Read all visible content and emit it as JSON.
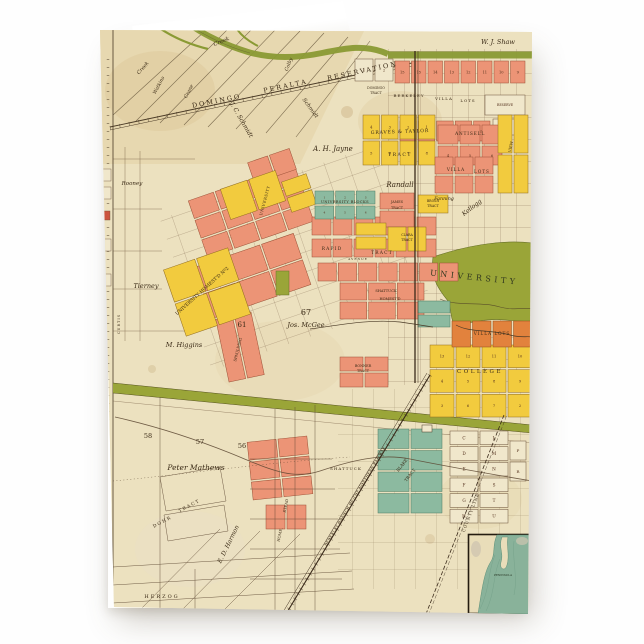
{
  "card": {
    "kind": "folded-greeting-card",
    "background_color": "#fefefe"
  },
  "map": {
    "colors": {
      "paper": "#ece1bf",
      "paper_dark": "#e3d1a4",
      "salmon": "#ec9476",
      "yellow": "#f2cb3e",
      "orange": "#e2823d",
      "teal": "#8cbaa0",
      "olive": "#9aa538",
      "creek": "#8a9a34",
      "water": "#89b29a",
      "cream": "#f0e7cb",
      "line": "#4a3a26",
      "text": "#3a2a16"
    },
    "clusters": [
      {
        "n": "top-numbers-row",
        "f": "salmon",
        "x": 295,
        "y": 32,
        "w": 130,
        "h": 22,
        "r": 1,
        "c": 8,
        "cl": [
          "15",
          "15",
          "14",
          "13",
          "12",
          "11",
          "10",
          "9"
        ]
      },
      {
        "n": "villa-17-21-row",
        "f": "salmon",
        "x": 300,
        "y": 92,
        "w": 90,
        "h": 20,
        "r": 1,
        "c": 5,
        "cl": [
          "17",
          "18",
          "19",
          "20",
          "21"
        ]
      },
      {
        "n": "reserve-block",
        "f": "cream",
        "x": 385,
        "y": 66,
        "w": 40,
        "h": 20,
        "r": 1,
        "c": 1,
        "cl": [
          "RESERVE"
        ],
        "ls": 3.2
      },
      {
        "n": "block-24",
        "f": "cream",
        "x": 393,
        "y": 90,
        "w": 22,
        "h": 16,
        "r": 1,
        "c": 1,
        "cl": [
          "24"
        ],
        "ls": 3.6
      },
      {
        "n": "blocks-1-2",
        "f": "cream",
        "x": 255,
        "y": 30,
        "w": 38,
        "h": 22,
        "r": 1,
        "c": 2,
        "cl": [
          "1",
          "2"
        ],
        "ls": 3.6
      },
      {
        "n": "graves-taylor",
        "f": "yellow",
        "x": 263,
        "y": 86,
        "w": 72,
        "h": 50,
        "r": 2,
        "c": 4,
        "cl": [
          "4",
          "3",
          "2",
          "1",
          "5",
          "6",
          "7",
          "8"
        ]
      },
      {
        "n": "antisell",
        "f": "salmon",
        "x": 338,
        "y": 96,
        "w": 64,
        "h": 40,
        "r": 2,
        "c": 3,
        "cl": [
          "",
          "",
          "",
          "4",
          "5",
          "6"
        ]
      },
      {
        "n": "villa-lots-rows",
        "f": "salmon",
        "x": 335,
        "y": 128,
        "w": 58,
        "h": 36,
        "r": 2,
        "c": 3
      },
      {
        "n": "view-strip",
        "f": "yellow",
        "x": 398,
        "y": 86,
        "w": 30,
        "h": 78,
        "r": 2,
        "c": 2
      },
      {
        "n": "central-a",
        "f": "salmon",
        "x": 95,
        "y": 152,
        "w": 112,
        "h": 60,
        "r": 3,
        "c": 4,
        "a": -19
      },
      {
        "n": "central-b",
        "f": "salmon",
        "x": 100,
        "y": 220,
        "w": 105,
        "h": 54,
        "r": 2,
        "c": 3,
        "a": -19
      },
      {
        "n": "spaulding-strips",
        "f": "salmon",
        "x": 122,
        "y": 286,
        "w": 36,
        "h": 64,
        "r": 1,
        "c": 2,
        "a": -12
      },
      {
        "n": "central-pair",
        "f": "salmon",
        "x": 150,
        "y": 126,
        "w": 44,
        "h": 22,
        "r": 1,
        "c": 2,
        "a": -19
      },
      {
        "n": "rapid-row-1",
        "f": "salmon",
        "x": 212,
        "y": 188,
        "w": 124,
        "h": 18,
        "r": 1,
        "c": 6
      },
      {
        "n": "rapid-row-2",
        "f": "salmon",
        "x": 212,
        "y": 210,
        "w": 124,
        "h": 18,
        "r": 1,
        "c": 6
      },
      {
        "n": "rapid-row-3",
        "f": "salmon",
        "x": 218,
        "y": 234,
        "w": 140,
        "h": 18,
        "r": 1,
        "c": 7
      },
      {
        "n": "shattuck-homestead",
        "f": "salmon",
        "x": 240,
        "y": 254,
        "w": 84,
        "h": 36,
        "r": 2,
        "c": 3
      },
      {
        "n": "james-tract",
        "f": "salmon",
        "x": 280,
        "y": 164,
        "w": 34,
        "h": 34,
        "r": 2,
        "c": 1
      },
      {
        "n": "brosh-tract",
        "f": "yellow",
        "x": 318,
        "y": 166,
        "w": 30,
        "h": 18,
        "r": 1,
        "c": 1
      },
      {
        "n": "bonner-tract",
        "f": "salmon",
        "x": 240,
        "y": 328,
        "w": 48,
        "h": 30,
        "r": 2,
        "c": 2
      },
      {
        "n": "mathews-blocks",
        "f": "salmon",
        "x": 150,
        "y": 410,
        "w": 60,
        "h": 58,
        "r": 3,
        "c": 2,
        "a": -6
      },
      {
        "n": "mathews-pair",
        "f": "salmon",
        "x": 166,
        "y": 476,
        "w": 40,
        "h": 24,
        "r": 1,
        "c": 2
      },
      {
        "n": "place-yellow",
        "f": "yellow",
        "x": 124,
        "y": 150,
        "w": 58,
        "h": 32,
        "r": 1,
        "c": 2,
        "a": -19
      },
      {
        "n": "place-yellow-small",
        "f": "yellow",
        "x": 186,
        "y": 148,
        "w": 26,
        "h": 32,
        "r": 2,
        "c": 1,
        "a": -19
      },
      {
        "n": "university-homestead-2",
        "f": "yellow",
        "x": 73,
        "y": 228,
        "w": 68,
        "h": 70,
        "r": 2,
        "c": 2,
        "a": -19
      },
      {
        "n": "clara-pair",
        "f": "yellow",
        "x": 256,
        "y": 194,
        "w": 30,
        "h": 26,
        "r": 2,
        "c": 1
      },
      {
        "n": "clara-tract",
        "f": "yellow",
        "x": 288,
        "y": 198,
        "w": 38,
        "h": 24,
        "r": 1,
        "c": 2
      },
      {
        "n": "college-homestead",
        "f": "yellow",
        "x": 330,
        "y": 316,
        "w": 102,
        "h": 72,
        "r": 3,
        "c": 4,
        "cl": [
          "13",
          "12",
          "11",
          "10",
          "4",
          "5",
          "8",
          "9",
          "3",
          "6",
          "7",
          "2"
        ]
      },
      {
        "n": "villa-lots-orange",
        "f": "orange",
        "x": 352,
        "y": 292,
        "w": 80,
        "h": 26,
        "r": 1,
        "c": 4
      },
      {
        "n": "university-blocks",
        "f": "teal",
        "x": 215,
        "y": 162,
        "w": 60,
        "h": 28,
        "r": 2,
        "c": 3,
        "cl": [
          "1",
          "2",
          "3",
          "4",
          "5",
          "6"
        ],
        "ls": 2.8
      },
      {
        "n": "blake-tract-1",
        "f": "teal",
        "x": 318,
        "y": 272,
        "w": 32,
        "h": 26,
        "r": 2,
        "c": 1
      },
      {
        "n": "blake-tract-grid",
        "f": "teal",
        "x": 278,
        "y": 400,
        "w": 64,
        "h": 84,
        "r": 4,
        "c": 2
      },
      {
        "n": "letter-blocks",
        "f": "cream",
        "x": 350,
        "y": 402,
        "w": 58,
        "h": 92,
        "r": 6,
        "c": 2,
        "cl": [
          "C",
          "L",
          "D",
          "M",
          "E",
          "N",
          "F",
          "S",
          "G",
          "T",
          "H",
          "U"
        ],
        "ls": 4.2
      },
      {
        "n": "letter-blocks-pr",
        "f": "cream",
        "x": 410,
        "y": 412,
        "w": 16,
        "h": 40,
        "r": 2,
        "c": 1,
        "cl": [
          "P",
          "R"
        ],
        "ls": 4
      },
      {
        "n": "olive-block",
        "f": "olive",
        "x": 176,
        "y": 242,
        "w": 13,
        "h": 24,
        "r": 1,
        "c": 1
      }
    ],
    "labels": [
      {
        "t": "W. J. Shaw",
        "x": 398,
        "y": 15,
        "s": 6.5,
        "c": "it"
      },
      {
        "t": "DOMINGO",
        "x": 117,
        "y": 74,
        "r": -11,
        "s": 6.5,
        "sp": 2
      },
      {
        "t": "PERALTA",
        "x": 186,
        "y": 59,
        "r": -12,
        "s": 6.5,
        "sp": 2
      },
      {
        "t": "RESERVATION",
        "x": 263,
        "y": 44,
        "r": -12,
        "s": 6.5,
        "sp": 2
      },
      {
        "t": "Creek",
        "x": 122,
        "y": 14,
        "r": -22,
        "s": 5.5,
        "c": "it"
      },
      {
        "t": "Creek",
        "x": 44,
        "y": 40,
        "r": -48,
        "s": 5,
        "c": "it"
      },
      {
        "t": "Watkins",
        "x": 60,
        "y": 57,
        "r": -62,
        "s": 4.8,
        "c": "it"
      },
      {
        "t": "Crane",
        "x": 90,
        "y": 63,
        "r": -62,
        "s": 4.8,
        "c": "it"
      },
      {
        "t": "Colby",
        "x": 190,
        "y": 36,
        "r": -68,
        "s": 4.8,
        "c": "it"
      },
      {
        "t": "J. C. Schmidt",
        "x": 140,
        "y": 92,
        "r": 60,
        "s": 6,
        "c": "it"
      },
      {
        "t": "Schmidt",
        "x": 209,
        "y": 80,
        "r": 54,
        "s": 5.5,
        "c": "it"
      },
      {
        "t": "A. H. Jayne",
        "x": 233,
        "y": 122,
        "s": 7,
        "c": "it"
      },
      {
        "t": "DOMINGO",
        "x": 276,
        "y": 60,
        "s": 3.2
      },
      {
        "t": "TRACT",
        "x": 276,
        "y": 65,
        "s": 3.2
      },
      {
        "t": "BERKELEY",
        "x": 309,
        "y": 68,
        "s": 4,
        "sp": 1
      },
      {
        "t": "VILLA",
        "x": 344,
        "y": 71,
        "s": 4,
        "sp": 1
      },
      {
        "t": "LOTS",
        "x": 368,
        "y": 73,
        "s": 4,
        "sp": 1
      },
      {
        "t": "GRAVES & TAYLOR",
        "x": 300,
        "y": 104,
        "r": -2,
        "s": 4.6,
        "sp": 0.8
      },
      {
        "t": "TRACT",
        "x": 300,
        "y": 127,
        "s": 4.6,
        "sp": 1.5
      },
      {
        "t": "ANTISELL",
        "x": 370,
        "y": 106,
        "s": 4.4,
        "sp": 0.8
      },
      {
        "t": "VILLA",
        "x": 356,
        "y": 142,
        "s": 4.2,
        "sp": 1
      },
      {
        "t": "LOTS",
        "x": 382,
        "y": 144,
        "s": 4.2,
        "sp": 1
      },
      {
        "t": "VIEW",
        "x": 412,
        "y": 118,
        "r": -78,
        "s": 3.8
      },
      {
        "t": "Randall",
        "x": 300,
        "y": 158,
        "s": 7,
        "c": "it"
      },
      {
        "t": "Fanning",
        "x": 344,
        "y": 171,
        "s": 4.8,
        "c": "it"
      },
      {
        "t": "Kellogg",
        "x": 373,
        "y": 180,
        "r": -38,
        "s": 6,
        "c": "it"
      },
      {
        "t": "JAMES",
        "x": 297,
        "y": 174,
        "s": 3.4
      },
      {
        "t": "TRACT",
        "x": 297,
        "y": 180,
        "s": 3.4
      },
      {
        "t": "BROSH",
        "x": 333,
        "y": 173,
        "s": 3.2
      },
      {
        "t": "TRACT",
        "x": 333,
        "y": 178,
        "s": 3.2
      },
      {
        "t": "UNIVERSITY BLOCKS",
        "x": 245,
        "y": 174,
        "s": 3.6,
        "sp": 0.4
      },
      {
        "t": "UNIVERSITY",
        "x": 166,
        "y": 172,
        "r": -75,
        "s": 3.8,
        "sp": 0.5
      },
      {
        "t": "RAPID",
        "x": 232,
        "y": 221,
        "s": 4.4,
        "sp": 1.2
      },
      {
        "t": "TRACT",
        "x": 282,
        "y": 225,
        "s": 4.4,
        "sp": 1.2
      },
      {
        "t": "AVENUE",
        "x": 258,
        "y": 231,
        "s": 3,
        "sp": 1
      },
      {
        "t": "SHATTUCK",
        "x": 286,
        "y": 263,
        "s": 3.6
      },
      {
        "t": "HOMEST'D",
        "x": 290,
        "y": 271,
        "s": 3.6
      },
      {
        "t": "UNIVERSITY",
        "x": 374,
        "y": 251,
        "r": 6,
        "s": 8,
        "sp": 3.5,
        "col": "#31381f"
      },
      {
        "t": "UNIVERSITY HOMEST'D Nº2",
        "x": 103,
        "y": 263,
        "r": -42,
        "s": 4.6
      },
      {
        "t": "SPAULDING",
        "x": 139,
        "y": 321,
        "r": -76,
        "s": 3.8
      },
      {
        "t": "Tierney",
        "x": 46,
        "y": 259,
        "s": 6.5,
        "c": "it"
      },
      {
        "t": "Rooney",
        "x": 32,
        "y": 156,
        "s": 5.5,
        "c": "it"
      },
      {
        "t": "61",
        "x": 142,
        "y": 298,
        "s": 7
      },
      {
        "t": "67",
        "x": 206,
        "y": 286,
        "s": 8
      },
      {
        "t": "Jos. McGee",
        "x": 206,
        "y": 298,
        "s": 6.5,
        "c": "it"
      },
      {
        "t": "M. Higgins",
        "x": 84,
        "y": 318,
        "s": 6.5,
        "c": "it"
      },
      {
        "t": "58",
        "x": 48,
        "y": 409,
        "s": 6.5
      },
      {
        "t": "57",
        "x": 100,
        "y": 415,
        "s": 6.5
      },
      {
        "t": "56",
        "x": 142,
        "y": 419,
        "s": 6.5
      },
      {
        "t": "Peter Mathews",
        "x": 96,
        "y": 441,
        "s": 7.5,
        "c": "it"
      },
      {
        "t": "BONNER",
        "x": 263,
        "y": 338,
        "s": 3.4
      },
      {
        "t": "TRACT",
        "x": 263,
        "y": 343,
        "s": 3.4
      },
      {
        "t": "CLARA",
        "x": 307,
        "y": 207,
        "s": 3.2
      },
      {
        "t": "TRACT",
        "x": 307,
        "y": 212,
        "s": 3.2
      },
      {
        "t": "SHATTUCK",
        "x": 246,
        "y": 441,
        "s": 4,
        "sp": 1
      },
      {
        "t": "BLAKE",
        "x": 303,
        "y": 437,
        "r": -52,
        "s": 4.2
      },
      {
        "t": "TRACT",
        "x": 311,
        "y": 447,
        "r": -52,
        "s": 4.2
      },
      {
        "t": "COLLEGE",
        "x": 380,
        "y": 344,
        "s": 5.5,
        "sp": 2.5
      },
      {
        "t": "VILLA  LOTS",
        "x": 392,
        "y": 306,
        "s": 4.2,
        "sp": 1
      },
      {
        "t": "BERKELEY BRANCH OF THE NORTHERN RAILWAY",
        "x": 256,
        "y": 468,
        "r": -59,
        "s": 3.7,
        "sp": 0.4
      },
      {
        "t": "COUNTY LINE",
        "x": 372,
        "y": 484,
        "r": -69,
        "s": 4,
        "sp": 1
      },
      {
        "t": "HOME.",
        "x": 181,
        "y": 506,
        "r": -78,
        "s": 3.8
      },
      {
        "t": "STEAD",
        "x": 187,
        "y": 477,
        "r": -78,
        "s": 3.8
      },
      {
        "t": "DOHR",
        "x": 63,
        "y": 494,
        "r": -28,
        "s": 4.5,
        "sp": 1.5
      },
      {
        "t": "TRACT",
        "x": 90,
        "y": 478,
        "r": -28,
        "s": 4.5,
        "sp": 1.5
      },
      {
        "t": "E. D. Harmon",
        "x": 130,
        "y": 516,
        "r": -64,
        "s": 6,
        "c": "it"
      },
      {
        "t": "HERZOG",
        "x": 62,
        "y": 569,
        "s": 5,
        "sp": 2
      },
      {
        "t": "CURTIS",
        "x": 20,
        "y": 295,
        "r": -90,
        "s": 3.5,
        "sp": 1
      },
      {
        "t": "PENINSULA",
        "x": 403,
        "y": 547,
        "s": 2.8,
        "col": "#23301f"
      }
    ]
  }
}
